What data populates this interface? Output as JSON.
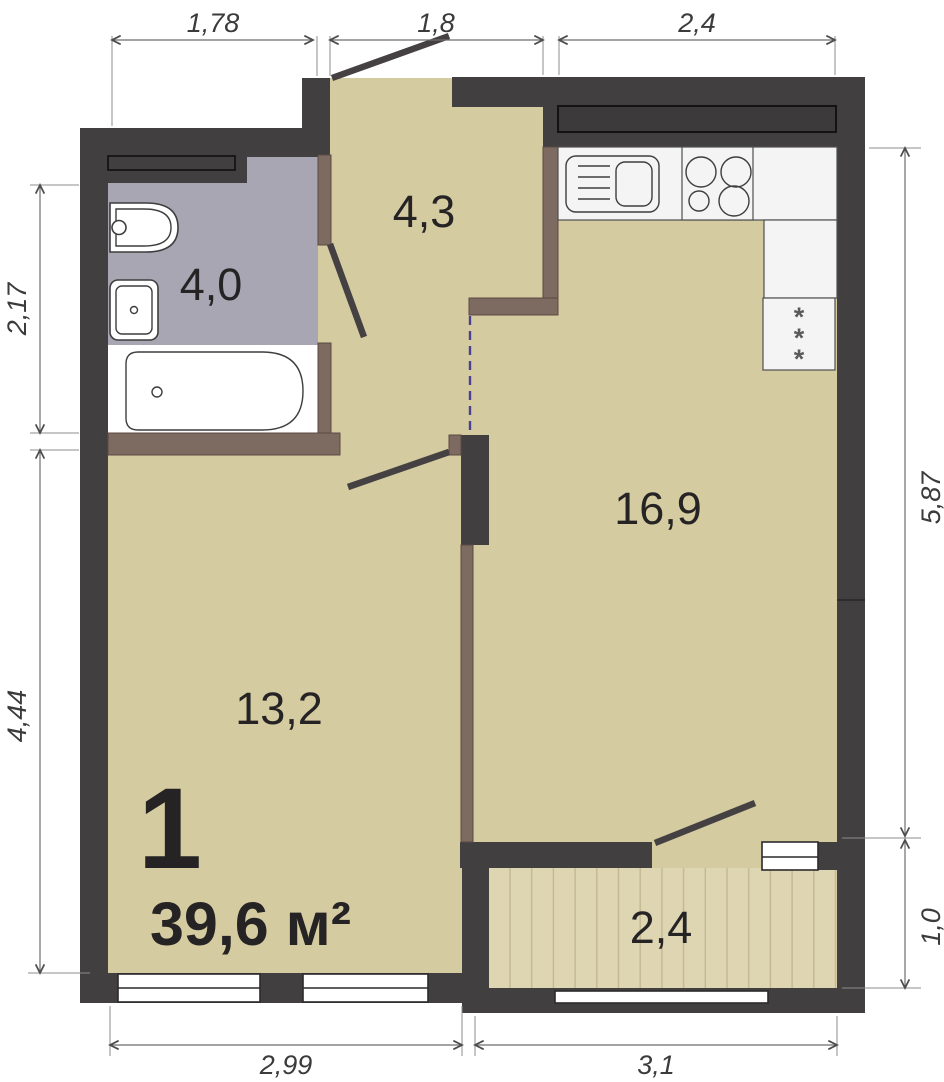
{
  "plan": {
    "unit_number": "1",
    "total_area": "39,6 м²",
    "rooms": {
      "hallway": "4,3",
      "bathroom": "4,0",
      "kitchen_living": "16,9",
      "bedroom": "13,2",
      "balcony": "2,4"
    },
    "dimensions": {
      "top_1": "1,78",
      "top_2": "1,8",
      "top_3": "2,4",
      "left_1": "2,17",
      "left_2": "4,44",
      "right_1": "5,87",
      "right_2": "1,0",
      "bottom_1": "2,99",
      "bottom_2": "3,1"
    },
    "fridge_marks": {
      "m1": "*",
      "m2": "*",
      "m3": "*"
    },
    "colors": {
      "wall": "#423f41",
      "floor": "#d5cba1",
      "bath_floor": "#a7a6b2",
      "wood": "#7d6a60",
      "balcony_floor": "#ded5b3",
      "virtual_line": "#4c4190",
      "counter_white": "#f4f4f4",
      "dim_ink": "#3b3b3b",
      "label_ink": "#262324"
    }
  }
}
